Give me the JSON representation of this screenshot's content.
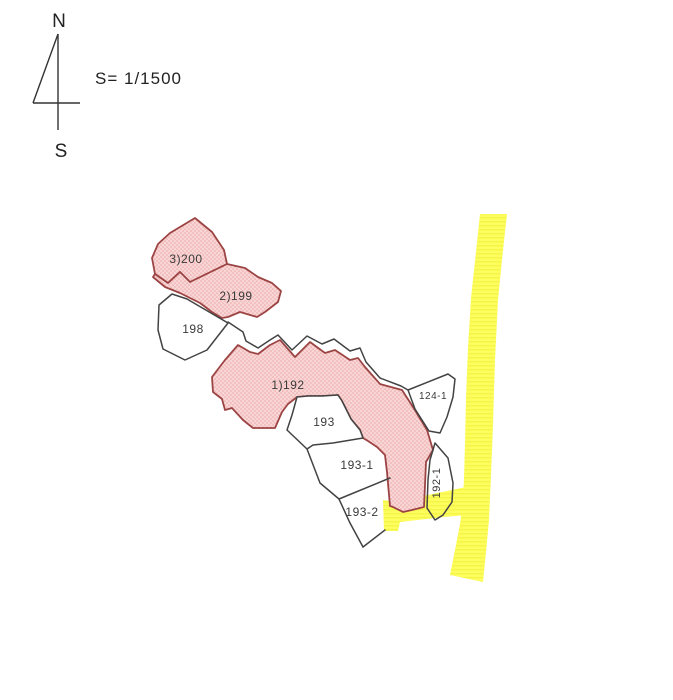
{
  "title_block": {
    "north_label": "N",
    "south_label": "S",
    "scale_text": "S= 1/1500"
  },
  "colors": {
    "background": "#ffffff",
    "pink_fill": "#f9d6d6",
    "pink_dot": "#eca6a6",
    "pink_stroke": "#9c4444",
    "yellow_fill": "#fdfd5e",
    "yellow_stripe": "#f3f33e",
    "line_color": "#434343",
    "label_color": "#3a3a3a"
  },
  "compass": {
    "segments": [
      {
        "id": "needle-shaft",
        "x1": 58,
        "y1": 34,
        "x2": 58,
        "y2": 130
      },
      {
        "id": "needle-diagonal",
        "x1": 58,
        "y1": 34,
        "x2": 33,
        "y2": 103
      },
      {
        "id": "needle-crossbar",
        "x1": 33,
        "y1": 103,
        "x2": 80,
        "y2": 103
      }
    ],
    "north_pos": {
      "x": 59,
      "y": 27
    },
    "south_pos": {
      "x": 61,
      "y": 157
    },
    "scale_pos": {
      "x": 95,
      "y": 84
    }
  },
  "map": {
    "roads": [
      {
        "id": "main",
        "points": [
          [
            480,
            214
          ],
          [
            507,
            214
          ],
          [
            503,
            250
          ],
          [
            498,
            300
          ],
          [
            495,
            360
          ],
          [
            493,
            425
          ],
          [
            491,
            475
          ],
          [
            489,
            520
          ],
          [
            486,
            552
          ],
          [
            483,
            582
          ],
          [
            450,
            575
          ],
          [
            455,
            550
          ],
          [
            460,
            524
          ],
          [
            463,
            503
          ],
          [
            464,
            478
          ],
          [
            465,
            444
          ],
          [
            466,
            398
          ],
          [
            468,
            348
          ],
          [
            471,
            298
          ],
          [
            476,
            252
          ]
        ]
      },
      {
        "id": "branch",
        "points": [
          [
            466,
            487
          ],
          [
            467,
            515
          ],
          [
            444,
            517
          ],
          [
            400,
            522
          ],
          [
            398,
            531
          ],
          [
            384,
            531
          ],
          [
            383,
            500
          ],
          [
            397,
            502
          ],
          [
            428,
            495
          ]
        ]
      }
    ],
    "parcels": [
      {
        "id": "200",
        "label": "3)200",
        "type": "highlight",
        "label_x": 186,
        "label_y": 263,
        "label_size": 12,
        "points": [
          [
            195,
            218
          ],
          [
            212,
            232
          ],
          [
            224,
            250
          ],
          [
            227,
            264
          ],
          [
            190,
            282
          ],
          [
            180,
            272
          ],
          [
            168,
            283
          ],
          [
            155,
            274
          ],
          [
            152,
            258
          ],
          [
            158,
            244
          ],
          [
            170,
            233
          ]
        ]
      },
      {
        "id": "199",
        "label": "2)199",
        "type": "highlight",
        "label_x": 236,
        "label_y": 300,
        "label_size": 12,
        "points": [
          [
            153,
            277
          ],
          [
            155,
            274
          ],
          [
            168,
            283
          ],
          [
            180,
            272
          ],
          [
            190,
            282
          ],
          [
            227,
            264
          ],
          [
            245,
            268
          ],
          [
            258,
            277
          ],
          [
            272,
            283
          ],
          [
            281,
            291
          ],
          [
            278,
            302
          ],
          [
            265,
            312
          ],
          [
            257,
            317
          ],
          [
            240,
            312
          ],
          [
            228,
            317
          ],
          [
            222,
            318
          ],
          [
            212,
            312
          ],
          [
            200,
            303
          ],
          [
            180,
            293
          ],
          [
            165,
            287
          ]
        ]
      },
      {
        "id": "192",
        "label": "1)192",
        "type": "highlight",
        "label_x": 288,
        "label_y": 389,
        "label_size": 12,
        "points": [
          [
            238,
            345
          ],
          [
            250,
            352
          ],
          [
            258,
            354
          ],
          [
            270,
            345
          ],
          [
            280,
            340
          ],
          [
            295,
            357
          ],
          [
            310,
            342
          ],
          [
            325,
            353
          ],
          [
            335,
            350
          ],
          [
            350,
            360
          ],
          [
            358,
            358
          ],
          [
            365,
            367
          ],
          [
            380,
            384
          ],
          [
            402,
            390
          ],
          [
            413,
            407
          ],
          [
            427,
            430
          ],
          [
            433,
            450
          ],
          [
            426,
            462
          ],
          [
            425,
            485
          ],
          [
            424,
            507
          ],
          [
            412,
            510
          ],
          [
            403,
            512
          ],
          [
            393,
            507
          ],
          [
            390,
            506
          ],
          [
            387,
            472
          ],
          [
            385,
            455
          ],
          [
            377,
            447
          ],
          [
            368,
            441
          ],
          [
            363,
            438
          ],
          [
            360,
            430
          ],
          [
            351,
            419
          ],
          [
            342,
            401
          ],
          [
            338,
            395
          ],
          [
            322,
            396
          ],
          [
            308,
            396
          ],
          [
            297,
            397
          ],
          [
            288,
            404
          ],
          [
            282,
            412
          ],
          [
            275,
            428
          ],
          [
            253,
            428
          ],
          [
            243,
            420
          ],
          [
            232,
            408
          ],
          [
            225,
            410
          ],
          [
            222,
            399
          ],
          [
            213,
            392
          ],
          [
            212,
            377
          ],
          [
            225,
            360
          ]
        ]
      },
      {
        "id": "198",
        "label": "198",
        "type": "plain",
        "label_x": 193,
        "label_y": 333,
        "label_size": 12,
        "points": [
          [
            172,
            294
          ],
          [
            187,
            299
          ],
          [
            228,
            323
          ],
          [
            207,
            350
          ],
          [
            185,
            360
          ],
          [
            163,
            349
          ],
          [
            158,
            330
          ],
          [
            159,
            305
          ]
        ]
      },
      {
        "id": "193",
        "label": "193",
        "type": "plain",
        "label_x": 324,
        "label_y": 426,
        "label_size": 12,
        "points": [
          [
            297,
            397
          ],
          [
            308,
            396
          ],
          [
            322,
            396
          ],
          [
            338,
            395
          ],
          [
            342,
            401
          ],
          [
            351,
            419
          ],
          [
            360,
            430
          ],
          [
            363,
            438
          ],
          [
            333,
            443
          ],
          [
            313,
            445
          ],
          [
            307,
            449
          ],
          [
            287,
            430
          ],
          [
            292,
            415
          ]
        ]
      },
      {
        "id": "124-1",
        "label": "124-1",
        "type": "plain",
        "label_x": 433,
        "label_y": 399,
        "label_size": 10,
        "points": [
          [
            408,
            390
          ],
          [
            448,
            374
          ],
          [
            455,
            379
          ],
          [
            453,
            397
          ],
          [
            447,
            417
          ],
          [
            440,
            433
          ],
          [
            429,
            431
          ],
          [
            415,
            409
          ]
        ]
      },
      {
        "id": "192-1",
        "label": "192-1",
        "type": "open",
        "label_x": 440,
        "label_y": 483,
        "label_size": 11,
        "label_rotation": -90,
        "points": [
          [
            435,
            443
          ],
          [
            448,
            458
          ],
          [
            453,
            483
          ],
          [
            452,
            502
          ],
          [
            443,
            515
          ],
          [
            435,
            520
          ],
          [
            427,
            508
          ],
          [
            428,
            480
          ],
          [
            430,
            460
          ]
        ]
      },
      {
        "id": "193-1",
        "label": "193-1",
        "type": "label-only",
        "label_x": 357,
        "label_y": 469,
        "label_size": 12,
        "points": null
      },
      {
        "id": "193-2",
        "label": "193-2",
        "type": "label-only",
        "label_x": 362,
        "label_y": 516,
        "label_size": 12,
        "points": null
      }
    ],
    "boundary_lines": [
      {
        "id": "corridor",
        "points": [
          [
            228,
            322
          ],
          [
            243,
            332
          ],
          [
            246,
            341
          ],
          [
            258,
            348
          ],
          [
            270,
            340
          ],
          [
            278,
            335
          ],
          [
            292,
            350
          ],
          [
            307,
            336
          ],
          [
            322,
            344
          ],
          [
            334,
            339
          ],
          [
            350,
            351
          ],
          [
            360,
            348
          ],
          [
            366,
            362
          ],
          [
            380,
            378
          ],
          [
            401,
            386
          ],
          [
            408,
            390
          ]
        ]
      },
      {
        "id": "block-left-edge",
        "points": [
          [
            307,
            449
          ],
          [
            320,
            483
          ],
          [
            339,
            499
          ],
          [
            350,
            523
          ],
          [
            363,
            547
          ]
        ]
      },
      {
        "id": "divider-193-1-193-2",
        "points": [
          [
            339,
            499
          ],
          [
            390,
            478
          ]
        ]
      },
      {
        "id": "bottom-193-2",
        "points": [
          [
            363,
            547
          ],
          [
            385,
            530
          ]
        ]
      }
    ]
  }
}
